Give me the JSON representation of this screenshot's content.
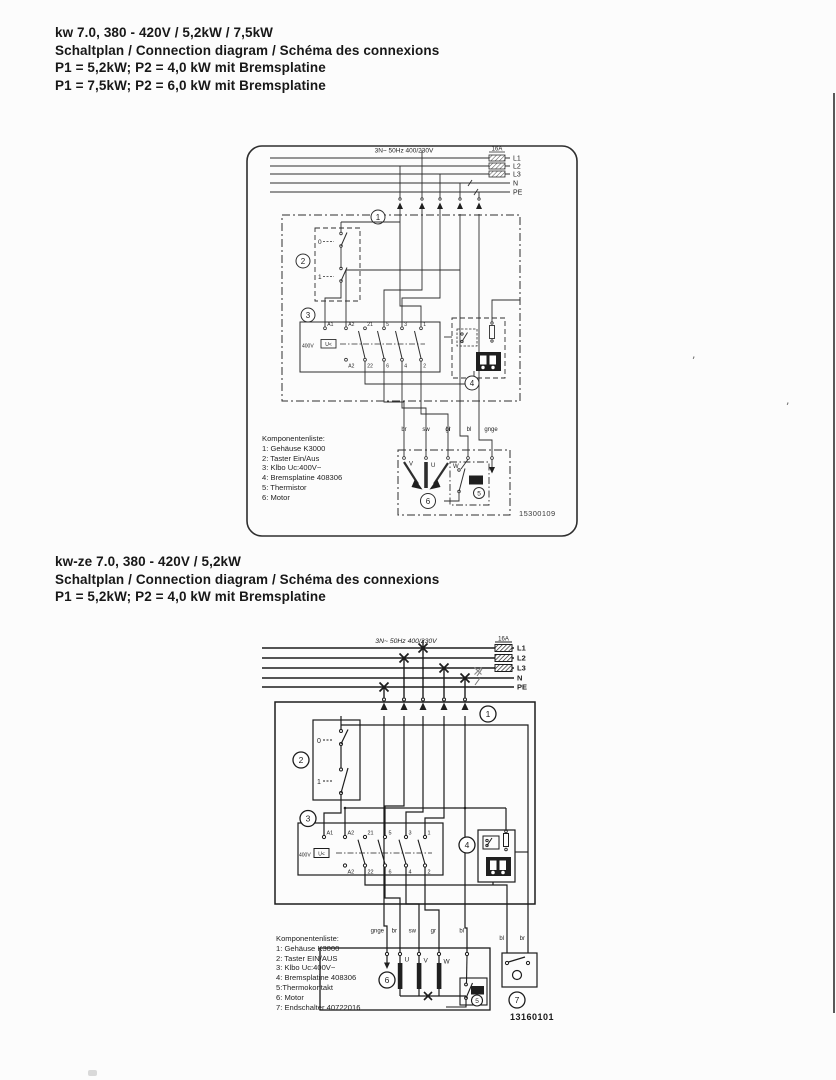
{
  "colors": {
    "ink": "#1f1f1f",
    "paper": "#fcfcfc"
  },
  "artifacts": {
    "quote1": "’",
    "quote2": "’"
  },
  "section1": {
    "heading": {
      "line1": "kw 7.0, 380 - 420V / 5,2kW / 7,5kW",
      "line2": "Schaltplan / Connection diagram / Schéma des connexions",
      "line3": "P1 = 5,2kW; P2 = 4,0 kW mit Bremsplatine",
      "line4": "P1 = 7,5kW; P2 = 6,0 kW mit Bremsplatine"
    },
    "diagram": {
      "supply_label": "3N~ 50Hz 400/230V",
      "fuse_rating": "16A",
      "line_labels": [
        "L1",
        "L2",
        "L3",
        "N",
        "PE"
      ],
      "callouts": [
        "1",
        "2",
        "3",
        "4",
        "5",
        "6"
      ],
      "switch": {
        "off": "0",
        "on": "1"
      },
      "contactor": {
        "voltage": "400V",
        "undervoltage": "U<",
        "top_terminals": [
          "A1",
          "A2",
          "21",
          "5",
          "3",
          "1"
        ],
        "bottom_terminals": [
          "A2",
          "22",
          "6",
          "4",
          "2"
        ]
      },
      "wire_labels": [
        "br",
        "sw",
        "gr",
        "bl",
        "gnge"
      ],
      "motor_terminals": [
        "V",
        "U",
        "W"
      ],
      "thermo_badge": "150",
      "component_list": {
        "title": "Komponentenliste:",
        "items": [
          "1: Gehäuse K3000",
          "2: Taster Ein/Aus",
          "3: Klbo Uc:400V~",
          "4: Bremsplatine 408306",
          "5: Thermistor",
          "6: Motor"
        ]
      },
      "doc_number": "15300109"
    }
  },
  "section2": {
    "heading": {
      "line1": "kw-ze 7.0, 380 - 420V / 5,2kW",
      "line2": "Schaltplan / Connection diagram / Schéma des connexions",
      "line3": "P1 = 5,2kW; P2 = 4,0 kW mit Bremsplatine"
    },
    "diagram": {
      "supply_label": "3N~ 50Hz 400/230V",
      "fuse_rating": "16A",
      "line_labels": [
        "L1",
        "L2",
        "L3",
        "N",
        "PE"
      ],
      "callouts": [
        "1",
        "2",
        "3",
        "4",
        "5",
        "6",
        "7"
      ],
      "switch": {
        "off": "0",
        "on": "1"
      },
      "contactor": {
        "voltage": "400V",
        "undervoltage": "U<",
        "top_terminals": [
          "A1",
          "A2",
          "21",
          "5",
          "3",
          "1"
        ],
        "bottom_terminals": [
          "A2",
          "22",
          "6",
          "4",
          "2"
        ]
      },
      "wire_labels": [
        "gnge",
        "br",
        "sw",
        "gr",
        "bl"
      ],
      "limit_switch_wires": [
        "bl",
        "br"
      ],
      "motor_terminals": [
        "U",
        "V",
        "W"
      ],
      "thermo_badge": "150",
      "component_list": {
        "title": "Komponentenliste:",
        "items": [
          "1: Gehäuse K3000",
          "2: Taster EIN/AUS",
          "3: Klbo Uc:400V~",
          "4: Bremsplatine 408306",
          "5:Thermokontakt",
          "6: Motor",
          "7: Endschalter 40722016"
        ]
      },
      "doc_number": "13160101"
    }
  }
}
